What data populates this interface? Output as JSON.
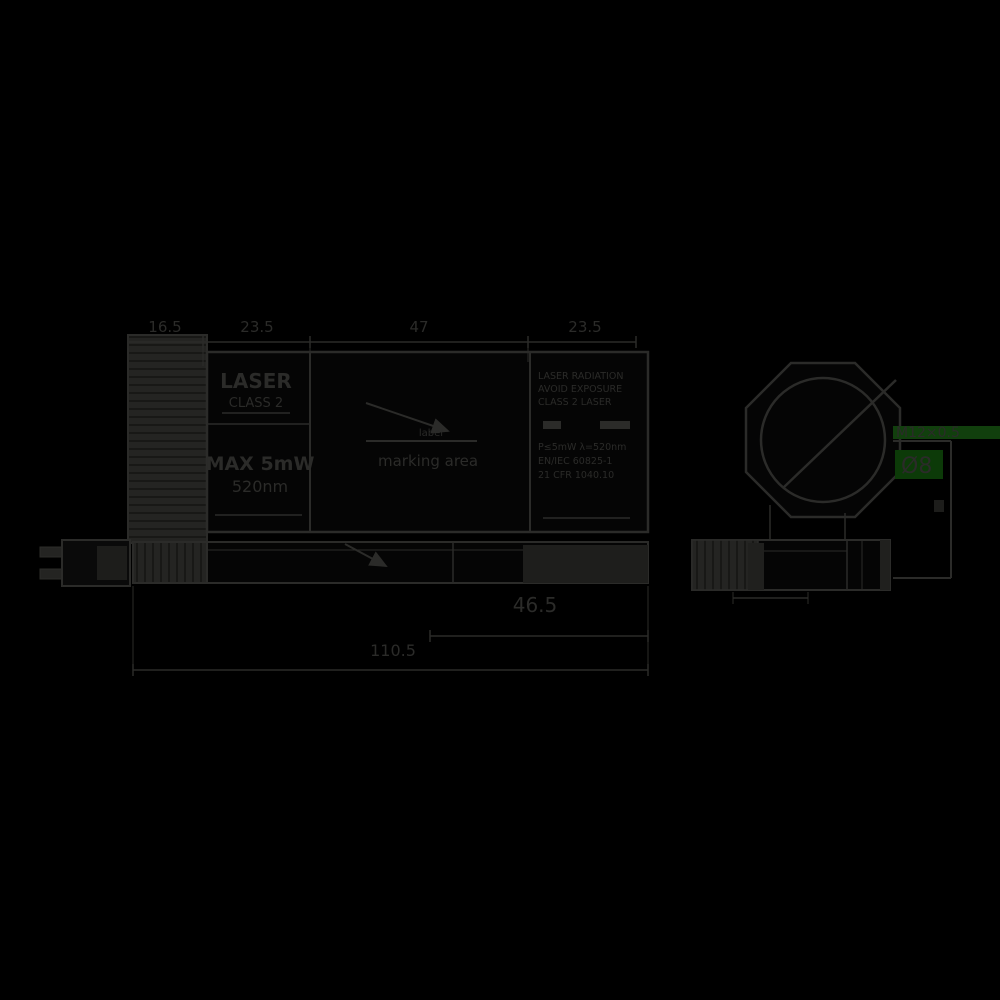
{
  "colors": {
    "background": "#000000",
    "ink": "#2b2b29",
    "knurl_fill": "#242422",
    "green_bar": "#113f0d",
    "green_block": "#0c3a08",
    "green_text": "#1d5c17"
  },
  "dimensions": {
    "top_segment_1": "16.5",
    "top_segment_2": "23.5",
    "top_segment_3": "47",
    "top_segment_4": "23.5",
    "rear_section": "46.5",
    "overall_length": "110.5"
  },
  "markings": {
    "panel_line_1": "LASER",
    "panel_line_2": "CLASS 2",
    "panel_line_3": "MAX 5mW",
    "panel_line_4": "520nm",
    "warning_rows": [
      "LASER RADIATION",
      "AVOID EXPOSURE",
      "CLASS 2 LASER",
      "P≤5mW λ=520nm",
      "EN/IEC 60825-1",
      "21 CFR 1040.10"
    ]
  },
  "callouts": {
    "center_top": "label",
    "center_bottom": "marking area",
    "front_thread": "M12×0.5",
    "front_aperture": "Ø8"
  }
}
